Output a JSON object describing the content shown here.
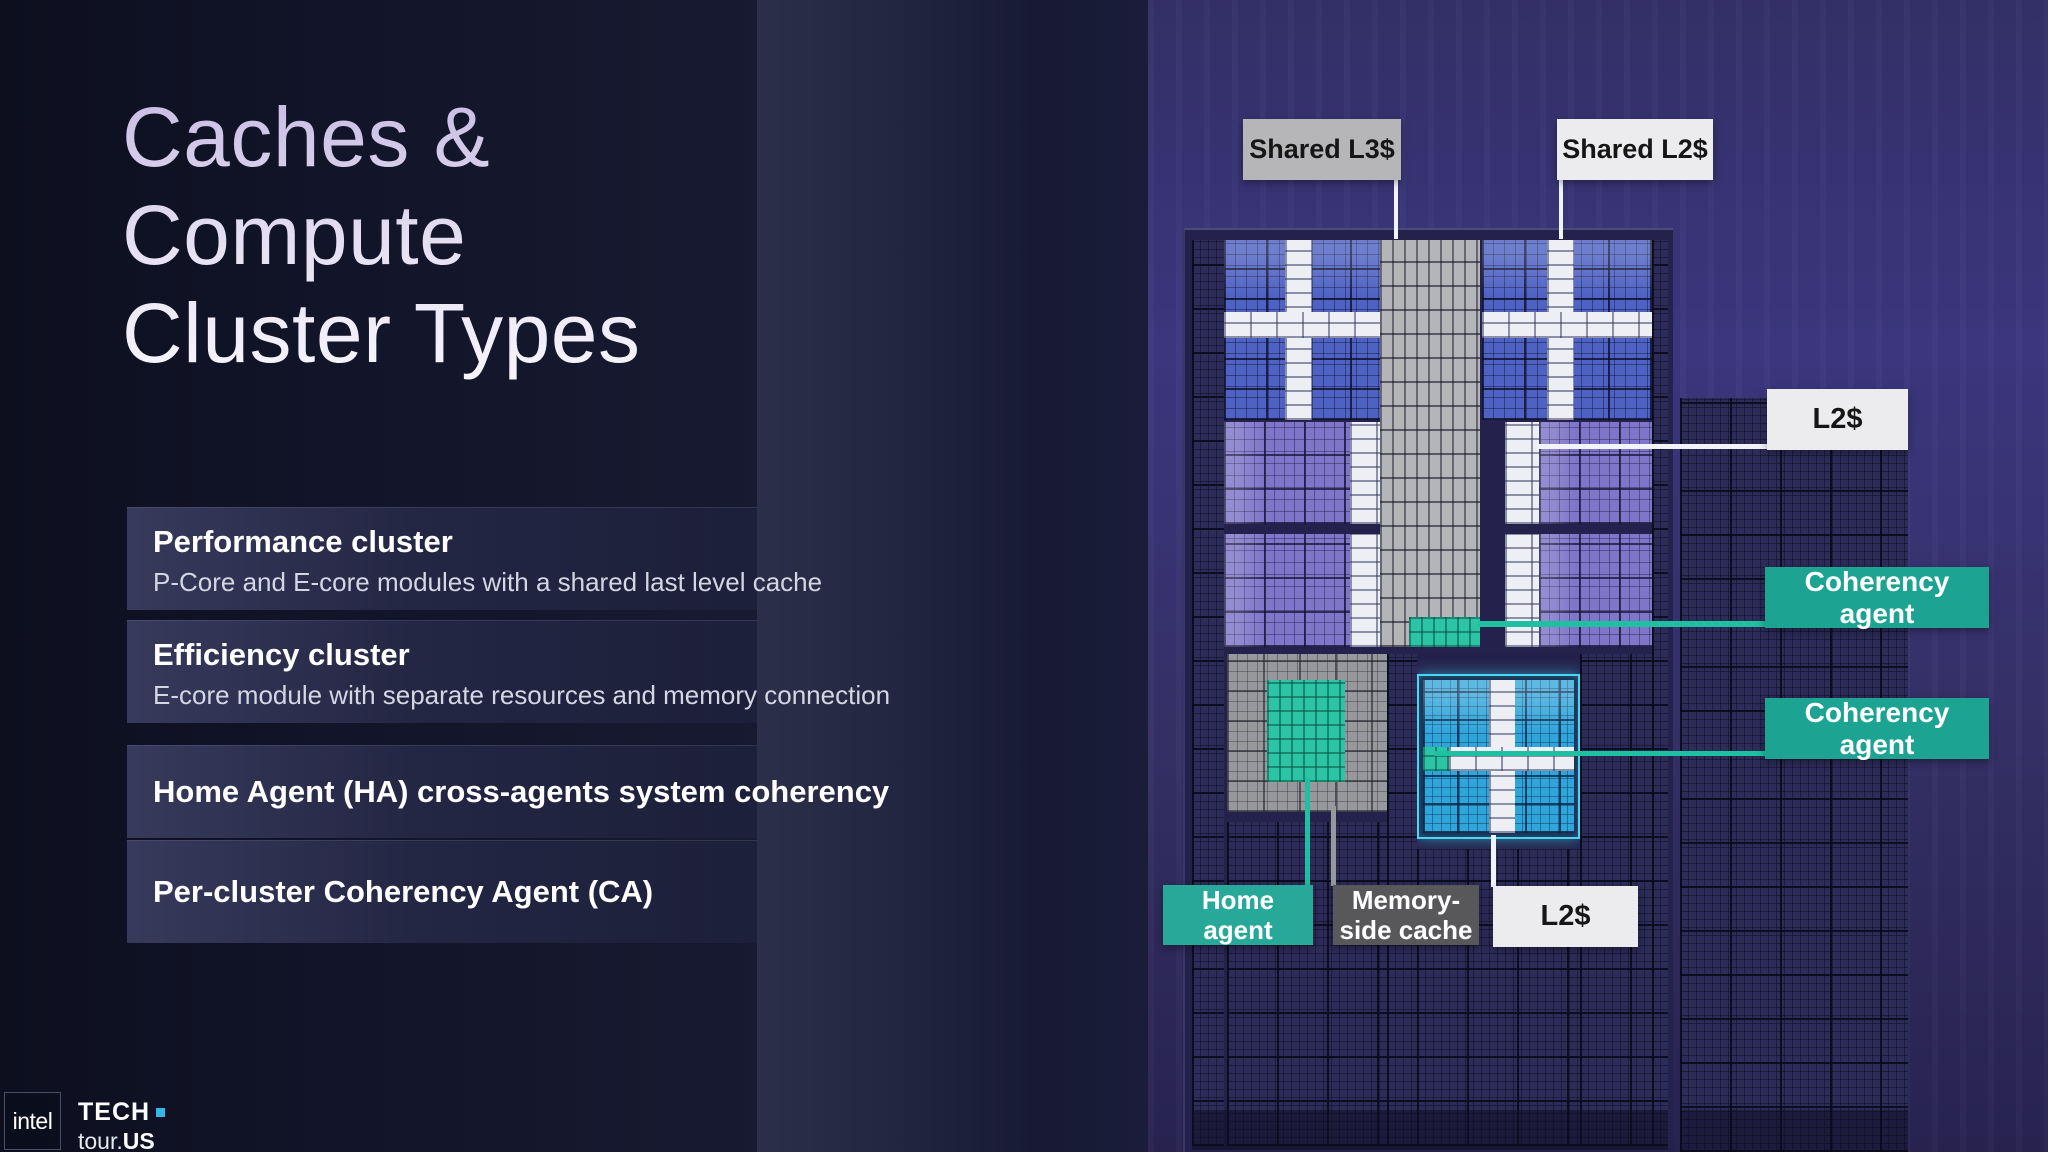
{
  "slide": {
    "title_lines": [
      "Caches &",
      "Compute",
      "Cluster Types"
    ],
    "cards": [
      {
        "title": "Performance cluster",
        "subtitle": "P-Core and E-core modules with a shared last level cache"
      },
      {
        "title": "Efficiency cluster",
        "subtitle": "E-core module with separate resources and memory connection"
      },
      {
        "title": "Home Agent (HA) cross-agents system coherency"
      },
      {
        "title": "Per-cluster Coherency Agent (CA)"
      }
    ]
  },
  "diagram": {
    "labels": {
      "shared_l3": "Shared L3$",
      "shared_l2": "Shared L2$",
      "l2_top": "L2$",
      "coherency_agent_1": "Coherency agent",
      "coherency_agent_2": "Coherency agent",
      "home_agent": {
        "line1": "Home",
        "line2": "agent"
      },
      "memory_side_cache": {
        "line1": "Memory-",
        "line2": "side cache"
      },
      "l2_bottom": "L2$"
    },
    "colors": {
      "teal_accent": "#1CA392",
      "green_highlight": "#2BC4A4",
      "cyan_outline": "#45D7F3",
      "l3_box_gray": "#B6B6B9",
      "label_white": "#ECECEE",
      "memory_box_gray": "#58585B"
    }
  },
  "footer": {
    "intel_logo": "intel",
    "tech": "TECH",
    "tour": "tour.",
    "tour_suffix": "US",
    "dot_color": "#35B6E8"
  }
}
